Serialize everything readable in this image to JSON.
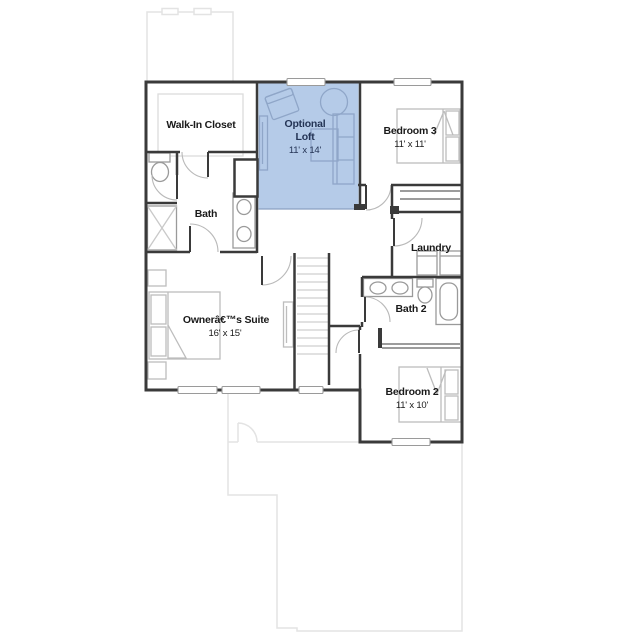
{
  "plan": {
    "background_color": "#ffffff",
    "wall_color": "#3a3a3a",
    "fixture_color": "#9a9a9a",
    "furniture_color": "#bdbdbd",
    "carpet_outline_color": "#dcdcdc",
    "door_arc_color": "#b9b9b9",
    "window_frame_color": "#9a9a9a",
    "stair_tread_color": "#cfcfcf",
    "faint_outline_color": "#e3e3e3",
    "highlight_fill": "#b5cbe8",
    "highlight_edge_color": "#8aa1c2",
    "highlight_outline_color": "#8fa6c8",
    "highlight_text_color": "#243455",
    "label_color": "#1a1a1a",
    "rooms": {
      "walk_in_closet": {
        "label": "Walk-In Closet"
      },
      "optional_loft": {
        "label_line1": "Optional",
        "label_line2": "Loft",
        "dims": "11' x 14'"
      },
      "bedroom3": {
        "label": "Bedroom 3",
        "dims": "11' x 11'"
      },
      "bath": {
        "label": "Bath"
      },
      "laundry": {
        "label": "Laundry"
      },
      "bath2": {
        "label": "Bath 2"
      },
      "owners_suite": {
        "label": "Ownerâ€™s Suite",
        "dims": "16' x 15'"
      },
      "bedroom2": {
        "label": "Bedroom 2",
        "dims": "11' x 10'"
      }
    }
  }
}
